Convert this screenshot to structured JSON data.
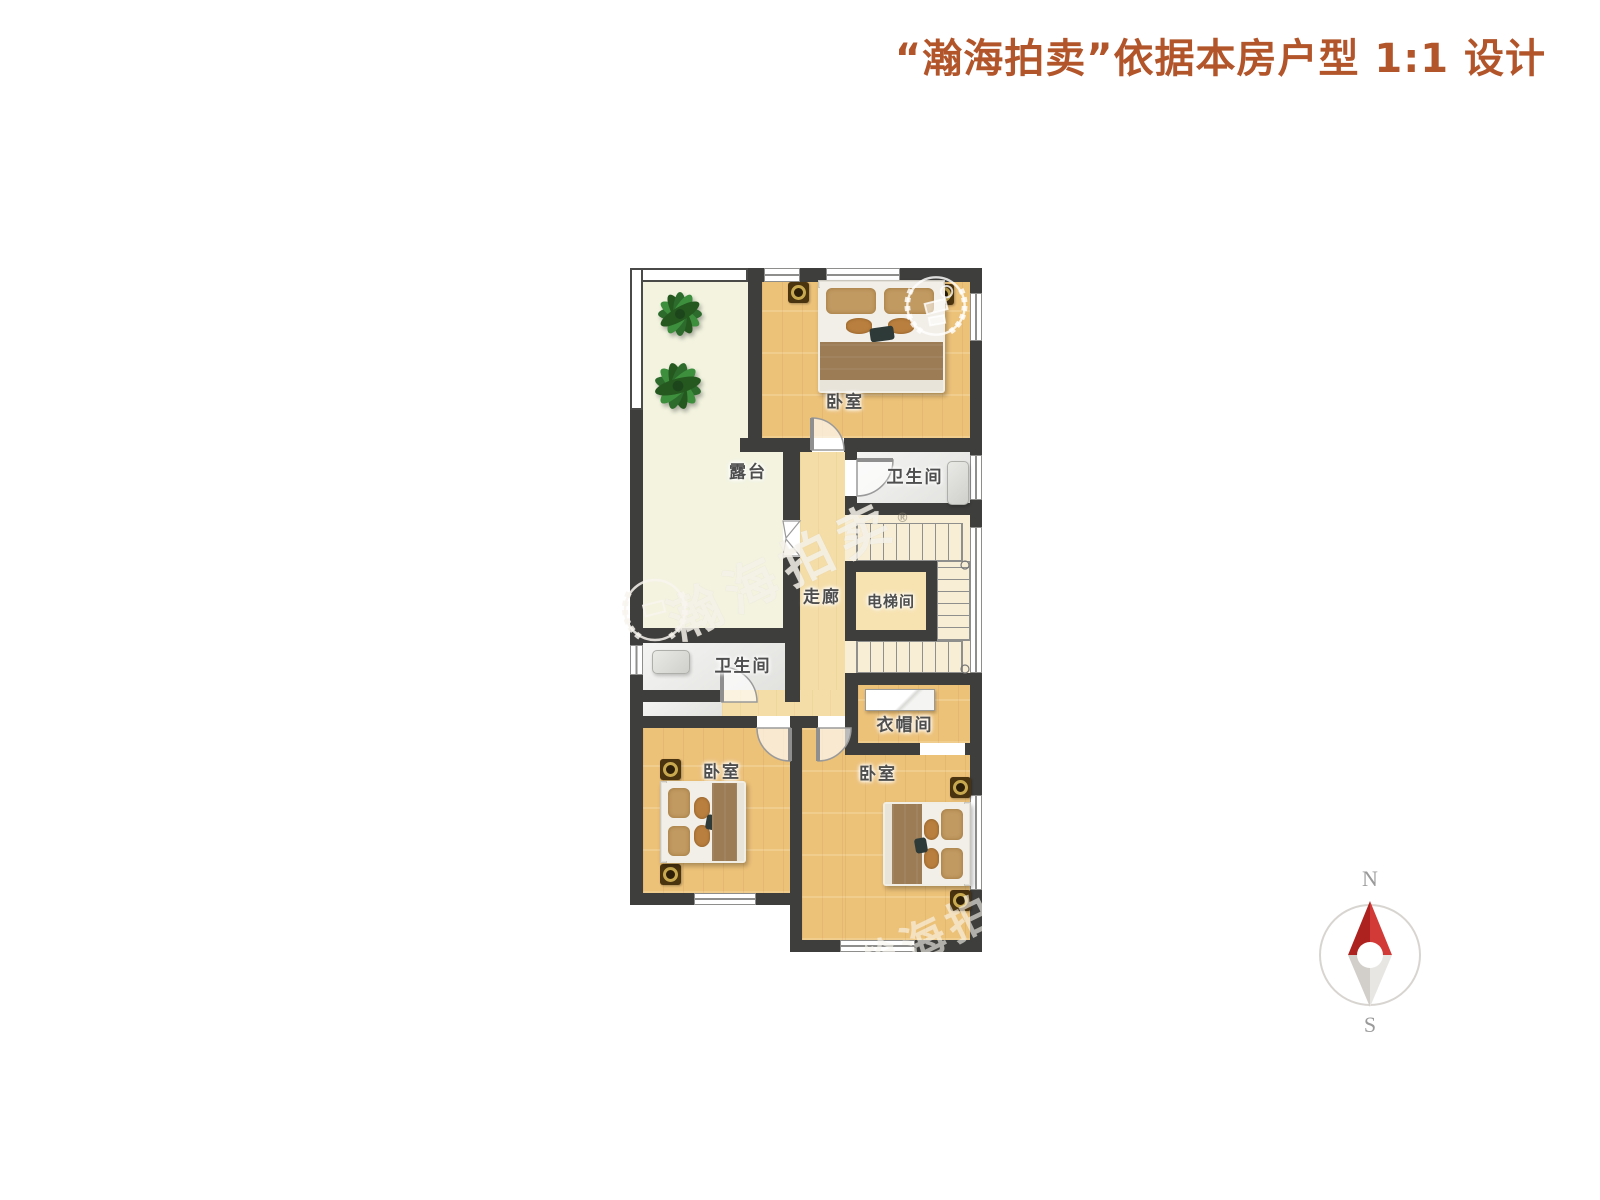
{
  "header": {
    "title": "“瀚海拍卖”依据本房户型 1:1 设计"
  },
  "floor_plan": {
    "rooms": [
      {
        "id": "terrace",
        "label": "露台"
      },
      {
        "id": "bedroom-top",
        "label": "卧室"
      },
      {
        "id": "bathroom-top",
        "label": "卫生间"
      },
      {
        "id": "corridor",
        "label": "走廊"
      },
      {
        "id": "elevator-room",
        "label": "电梯间"
      },
      {
        "id": "bathroom-left",
        "label": "卫生间"
      },
      {
        "id": "cloakroom",
        "label": "衣帽间"
      },
      {
        "id": "bedroom-left",
        "label": "卧室"
      },
      {
        "id": "bedroom-right",
        "label": "卧室"
      }
    ],
    "watermark": {
      "text": "瀚海拍卖",
      "registered": "®",
      "corner_text": "瀚海拍卖"
    }
  },
  "compass": {
    "north": "N",
    "south": "S"
  },
  "colors": {
    "header_text": "#b2552a",
    "wall": "#3e3e3c",
    "bedroom_floor": "#ecc178",
    "corridor_floor": "#f4dda7",
    "terrace_floor": "#f3f3e0",
    "bathroom_floor": "#e9e9e6",
    "stairs_floor": "#f8eed6",
    "compass_needle_red": "#c4302b"
  }
}
